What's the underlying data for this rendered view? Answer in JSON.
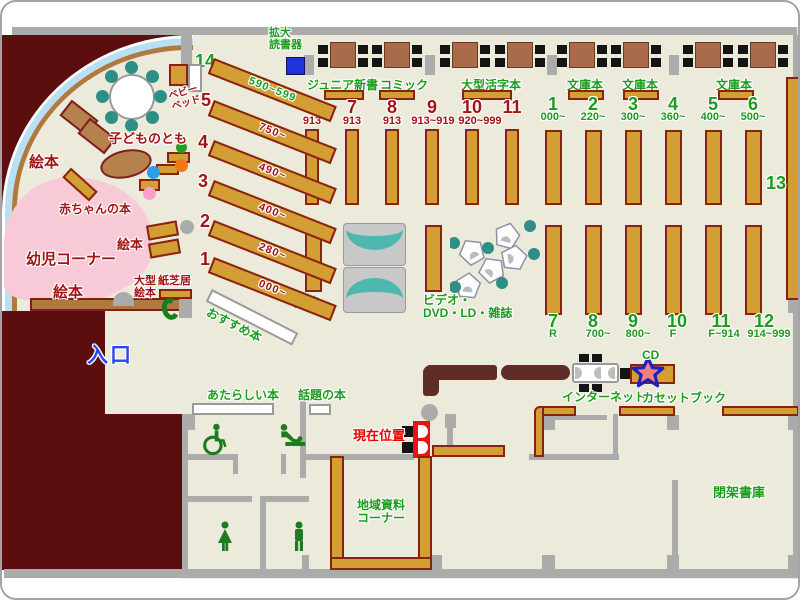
{
  "area_labels": {
    "entrance": "入口",
    "magnifier": "拡大\n読書器",
    "magazines": "雑誌",
    "av": "ビデオ・\nDVD・LD・雑誌",
    "internet": "インターネット",
    "cd": "CD",
    "cassette_book": "カセットブック",
    "closed_stacks": "閉架書庫",
    "local_materials": "地域資料\nコーナー",
    "current_location": "現在位置",
    "new_books": "あたらしい本",
    "topic_books": "話題の本",
    "recommended": "おすすめ本",
    "shelf13": "13"
  },
  "children": {
    "picture_books_1": "絵本",
    "picture_books_2": "絵本",
    "picture_books_3": "絵本",
    "kodomo_no_tomo": "子どものとも",
    "baby_bed": "ベビー\nベッド",
    "baby_books": "赤ちゃんの本",
    "infant_corner": "幼児コーナー",
    "large_picture_books": "大型\n絵本",
    "kamishibai": "紙芝居"
  },
  "table_sections": [
    "ジュニア新書",
    "コミック",
    "大型活字本",
    "文庫本",
    "文庫本",
    "文庫本"
  ],
  "left_shelves": [
    {
      "no": "14",
      "range": "590~599"
    },
    {
      "no": "5",
      "range": "750~"
    },
    {
      "no": "4",
      "range": "490~"
    },
    {
      "no": "3",
      "range": "400~"
    },
    {
      "no": "2",
      "range": "280~"
    },
    {
      "no": "1",
      "range": "000~"
    }
  ],
  "mid_shelves": {
    "numbers": [
      "6",
      "7",
      "8",
      "9",
      "10",
      "11"
    ],
    "ranges": [
      "913",
      "913",
      "913",
      "913~919",
      "920~999"
    ]
  },
  "paperback_top": [
    {
      "no": "1",
      "range": "000~"
    },
    {
      "no": "2",
      "range": "220~"
    },
    {
      "no": "3",
      "range": "300~"
    },
    {
      "no": "4",
      "range": "360~"
    },
    {
      "no": "5",
      "range": "400~"
    },
    {
      "no": "6",
      "range": "500~"
    }
  ],
  "fiction_bottom": [
    {
      "no": "7",
      "range": "R"
    },
    {
      "no": "8",
      "range": "700~"
    },
    {
      "no": "9",
      "range": "800~"
    },
    {
      "no": "10",
      "range": "F"
    },
    {
      "no": "11",
      "range": "F~914"
    },
    {
      "no": "12",
      "range": "914~999"
    }
  ],
  "colors": {
    "floor": "#ECEADB",
    "exterior": "#5C0E0E",
    "shelf": "#D39E33",
    "green_text": "#1C9C1C",
    "dark_red_text": "#A31414",
    "entrance_blue": "#2946F0",
    "marker_red": "#EB0000",
    "infant_pink": "#F8C9D6",
    "window_blue": "#B9DFF2"
  }
}
